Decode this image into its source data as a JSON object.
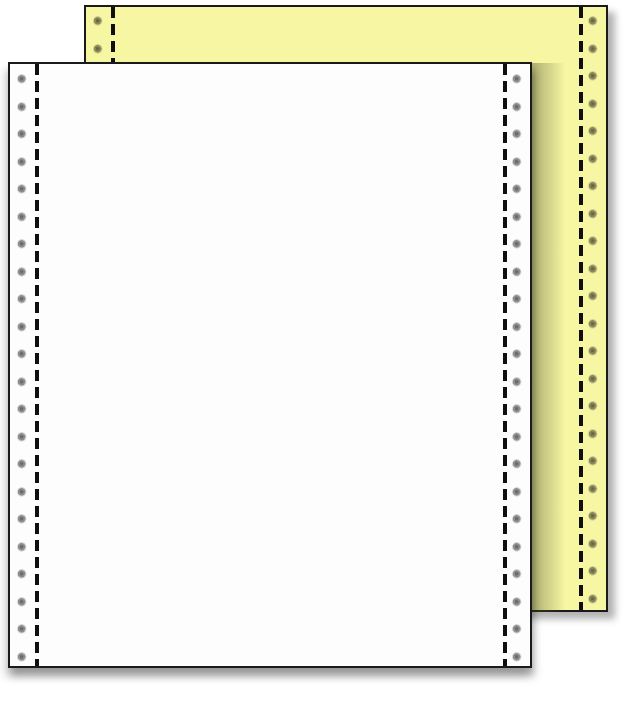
{
  "scene": {
    "description": "Product photo of two-part continuous fanfold computer printer paper: a white sheet in front overlapping a canary-yellow sheet behind, each with tractor-feed sprocket holes along both edges and vertical dashed perforation lines",
    "background_color": "#ffffff"
  },
  "back_sheet": {
    "name": "canary-yellow sheet",
    "paper_color": "#f6f6a3",
    "border_color": "#1a1a1a",
    "perforation_color": "#0f0f0f",
    "hole_outer_color": "#8f8f8f",
    "hole_inner_color": "#6d6d6d",
    "hole_columns": 2,
    "holes_per_column": 22
  },
  "front_sheet": {
    "name": "white sheet",
    "paper_color": "#fdfdfd",
    "border_color": "#1a1a1a",
    "perforation_color": "#0f0f0f",
    "hole_outer_color": "#8f8f8f",
    "hole_inner_color": "#6d6d6d",
    "hole_columns": 2,
    "holes_per_column": 22
  },
  "shadows": {
    "drop_shadow_color": "rgba(0,0,0,0.32)",
    "cast_shadow_color": "rgba(80,84,48,0.45)"
  }
}
